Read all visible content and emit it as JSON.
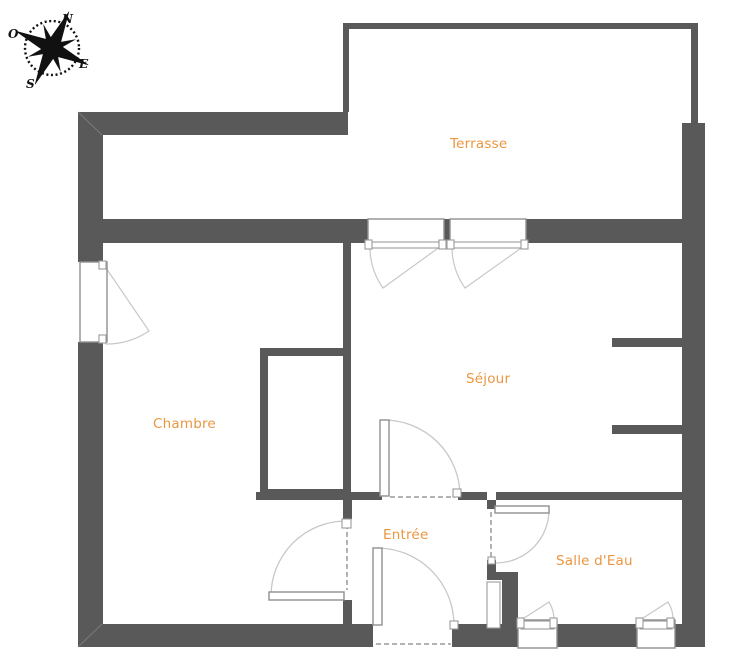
{
  "compass": {
    "north": "N",
    "east": "E",
    "south": "S",
    "west": "O"
  },
  "rooms": [
    {
      "id": "terrasse",
      "label": "Terrasse"
    },
    {
      "id": "sejour",
      "label": "Séjour"
    },
    {
      "id": "chambre",
      "label": "Chambre"
    },
    {
      "id": "entree",
      "label": "Entrée"
    },
    {
      "id": "salle-deau",
      "label": "Salle d'Eau"
    }
  ],
  "colors": {
    "wall": "#595959",
    "room_label": "#EB9640",
    "window_frame": "#909090",
    "door_arc": "#c8c8c8",
    "background": "#ffffff"
  }
}
